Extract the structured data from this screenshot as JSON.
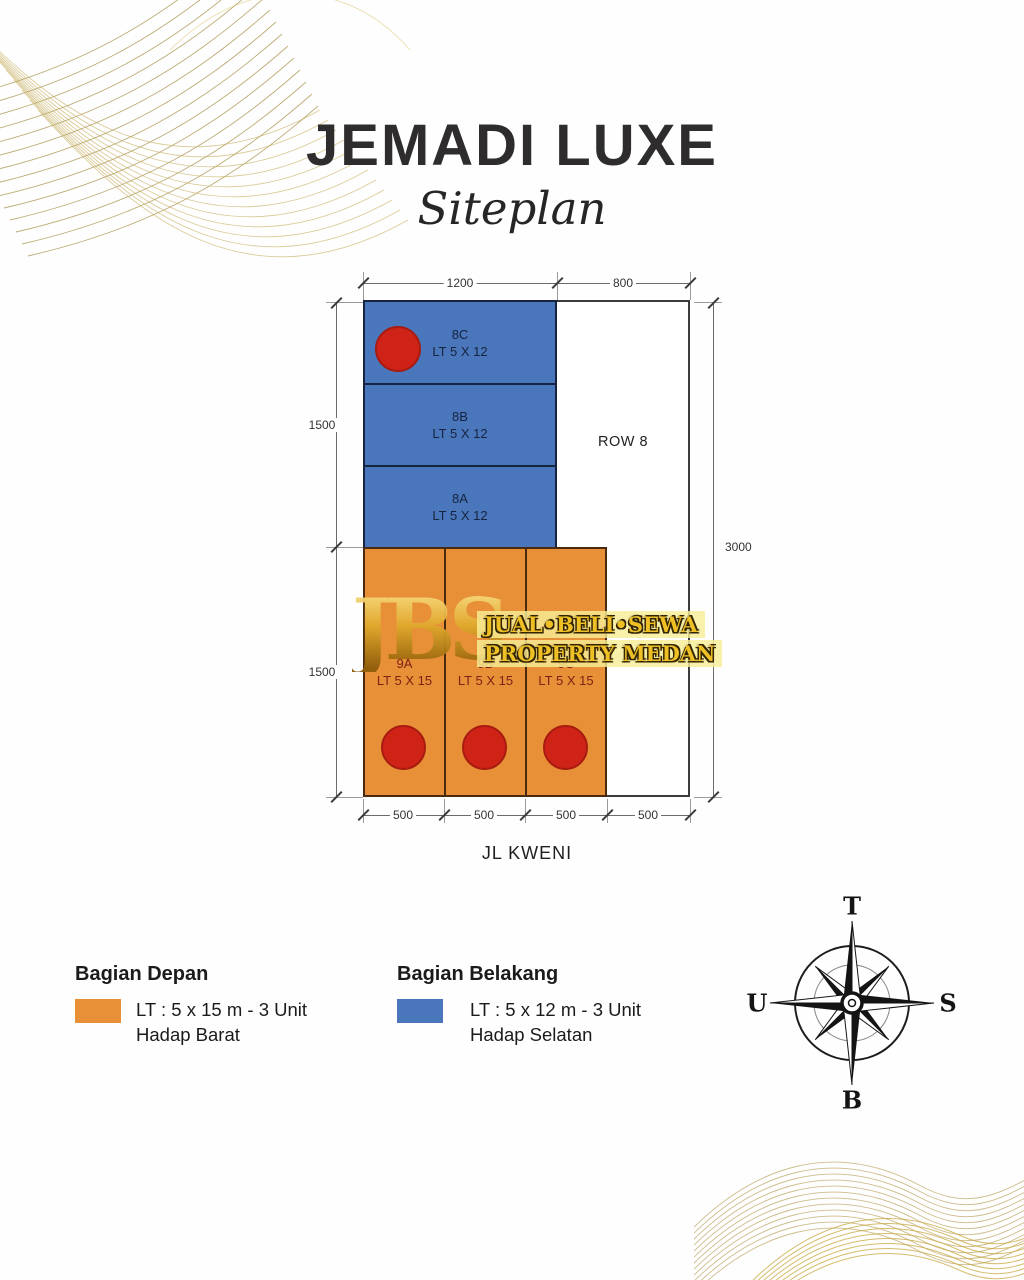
{
  "title": "JEMADI LUXE",
  "subtitle": "Siteplan",
  "plan": {
    "row_label": "ROW 8",
    "street": "JL KWENI",
    "back_units": [
      {
        "id": "8C",
        "size": "LT 5 X 12"
      },
      {
        "id": "8B",
        "size": "LT 5 X 12"
      },
      {
        "id": "8A",
        "size": "LT 5 X 12"
      }
    ],
    "front_units": [
      {
        "id": "9A",
        "size": "LT 5 X 15"
      },
      {
        "id": "9B",
        "size": "LT 5 X 15"
      },
      {
        "id": "9C",
        "size": "LT 5 X 15"
      }
    ],
    "dims": {
      "top_left": "1200",
      "top_right": "800",
      "left_upper": "1500",
      "left_lower": "1500",
      "right": "3000",
      "bottom": [
        "500",
        "500",
        "500",
        "500"
      ]
    }
  },
  "watermark": {
    "initials": "JBS",
    "line1": "JUAL•BELI•SEWA",
    "line2": "PROPERTY MEDAN"
  },
  "legend": {
    "front": {
      "heading": "Bagian Depan",
      "line1": "LT : 5 x 15 m - 3 Unit",
      "line2": "Hadap Barat",
      "color": "#E89038"
    },
    "back": {
      "heading": "Bagian Belakang",
      "line1": "LT : 5 x 12 m - 3 Unit",
      "line2": "Hadap Selatan",
      "color": "#4A76BC"
    }
  },
  "compass": {
    "top": "T",
    "right": "S",
    "bottom": "B",
    "left": "U"
  },
  "colors": {
    "front_orange": "#E89038",
    "back_blue": "#4A76BC",
    "marker_red": "#CF2318",
    "wave_gold": "#b59a4c"
  }
}
